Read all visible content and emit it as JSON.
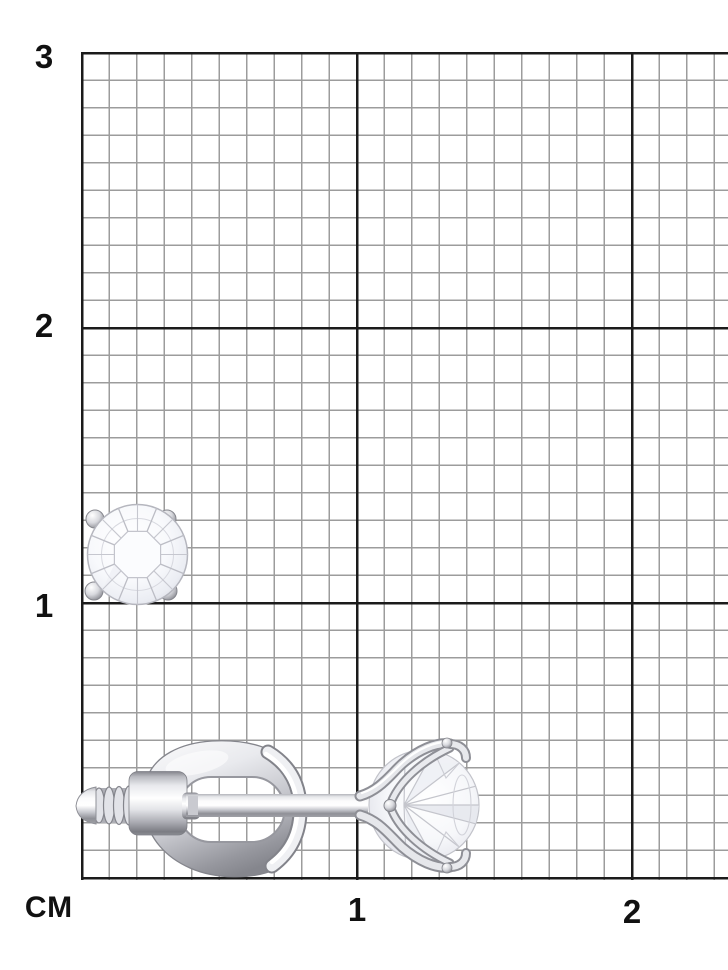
{
  "scale": {
    "unit_label": "СМ",
    "y_labels": [
      "3",
      "2",
      "1"
    ],
    "x_labels": [
      "1",
      "2"
    ]
  },
  "grid": {
    "background_color": "#ffffff",
    "major_line_color": "#1b1b1b",
    "minor_line_color": "#9c9c9c",
    "label_color": "#111111"
  },
  "subject": {
    "name": "diamond-stud-earring",
    "metal_highlight_color": "#ffffff",
    "metal_mid_color": "#d9dade",
    "metal_shadow_color": "#85868d",
    "gem_color": "#f7f8fc"
  }
}
